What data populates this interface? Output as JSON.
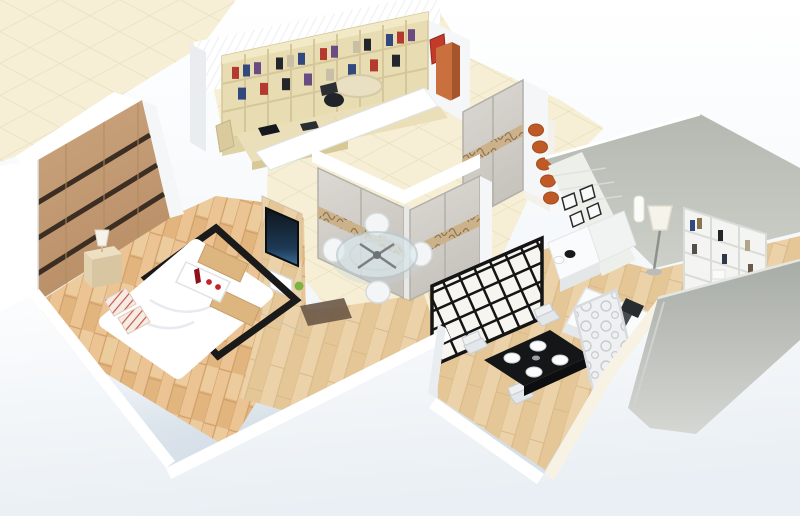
{
  "meta": {
    "title": "3D isometric apartment floor plan render",
    "type": "architectural-3d-render",
    "description": "Isometric cutaway render of a small apartment: bedroom with wardrobe and double bed, study with bookshelf wall, walk-in closet with sliding wardrobes and glass table set, home office with white shelving and floor lamp, dining nook with black table and lattice screen, all set on cream diamond tiles with white cut walls."
  },
  "palette": {
    "bgTop": "#ffffff",
    "bgBottom": "#d9e3ec",
    "tile": "#f6efd5",
    "tileLine": "#e6dcba",
    "tileStudy": "#f3ecd2",
    "wallWhite": "#ffffff",
    "wallSoft": "#f4f6f7",
    "wallShade": "#e9edef",
    "wallEdge": "#dde3e6",
    "ridge": "#eef1f3",
    "grayA": "#b4b8b0",
    "grayB": "#ccd0c8",
    "grayC": "#a8aca6",
    "grayD": "#d4d7d2",
    "woodA": "#ecc393",
    "woodB": "#e3b57e",
    "woodSeam": "#cf9f69",
    "woodPale": "#f4dcb4",
    "woodA2": "#ecd2a9",
    "woodB2": "#e5c797",
    "woodSeam2": "#d9b988",
    "wardWoodA": "#cba67f",
    "wardWoodB": "#b98e67",
    "wardStripe": "#3c2e22",
    "shelfWood": "#e8ddb2",
    "shelfEdge": "#d5c79a",
    "shelfBase": "#dfd3a6",
    "deskWood": "#eadfb8",
    "deskEdge": "#d6c996",
    "bookRed": "#b23a2e",
    "bookBlue": "#31497c",
    "bookPurple": "#6a4b82",
    "bookDark": "#23262b",
    "bookTan": "#c8bfa4",
    "accentOrange": "#c9703e",
    "accentOrangeDark": "#a4552a",
    "discOrange": "#bf5a26",
    "artRed": "#c23a2a",
    "doorA": "#dcd9d4",
    "doorB": "#c6c2bc",
    "doorFrame": "#b3afa9",
    "bandBg": "#cbb28b",
    "bandLine": "#8e7352",
    "tvDark": "#0e151d",
    "tvGlow": "#3e6f9e",
    "rugBlack": "#1a1a1a",
    "black": "#141618",
    "chairDark": "#202428",
    "glassFill": "#dce8ec",
    "glassRim": "#b9c6cb",
    "white": "#ffffff",
    "duvetShade": "#e7eaee",
    "itemRed": "#c3242c",
    "bottleRed": "#8e1018",
    "plantGreen": "#7cb342",
    "lampShade": "#f6f3ea",
    "screenFill": "#eef0f1",
    "curl": "#c8ccd0",
    "latticeBg": "#f7f5ef",
    "latticeLine": "#151515",
    "slatWall": "#edf0ea",
    "slatLine": "#dde0da",
    "tableWhite": "#fafbfc",
    "blotter": "#474c52",
    "runner": "#6b5847",
    "cream": "#f7f2e4"
  },
  "scene": {
    "label": "3D isometric apartment model",
    "rooms": {
      "bedroom": {
        "label": "Bedroom with wood floor, striped wardrobe and double bed"
      },
      "study": {
        "label": "Study with wall bookshelf and corner desk"
      },
      "closet": {
        "label": "Walk-in closet with sliding-door wardrobes and glass table set"
      },
      "office": {
        "label": "Home office with white shelving, desk and floor lamp"
      },
      "dining": {
        "label": "Dining nook with black table and lattice screen"
      },
      "ground": {
        "label": "Cream diamond-tiled ground plane"
      }
    },
    "furniture": {
      "bed": {
        "label": "Double bed with white duvet"
      },
      "bedRug": {
        "label": "Black border rug under bed"
      },
      "wardrobe": {
        "label": "Bedroom wardrobe with dark stripes"
      },
      "nightstand": {
        "label": "Nightstand with table lamp"
      },
      "tray": {
        "label": "Breakfast tray with red bottle and cups"
      },
      "pillows": {
        "label": "Striped pillows"
      },
      "tvPartition": {
        "label": "TV partition wall with flat screen"
      },
      "bookshelfWall": {
        "label": "Study bookshelf wall full of books"
      },
      "studyDesk": {
        "label": "Study corner desk with laptop and chair"
      },
      "orangeCabinet": {
        "label": "Orange tall cabinet"
      },
      "wallArt": {
        "label": "Red wall art"
      },
      "slidingWardrobes": {
        "label": "L-shaped sliding-door wardrobes with decorative band"
      },
      "neWardrobe": {
        "label": "Sliding-door wardrobe with decorative band"
      },
      "accentDiscs": {
        "label": "Orange半round wall accents"
      },
      "glassTable": {
        "label": "Round glass table with four white chairs"
      },
      "latticeScreen": {
        "label": "Black lattice partition screen"
      },
      "carvedScreen": {
        "label": "White carved divider screen"
      },
      "diningTable": {
        "label": "Black dining table with white plates and chairs"
      },
      "sideboard": {
        "label": "Stepped white sideboard with black bowl"
      },
      "frames": {
        "label": "Black picture frames"
      },
      "floorLamp": {
        "label": "Floor lamp with white shade"
      },
      "whiteBookshelf": {
        "label": "White office bookshelf"
      },
      "officeDesk": {
        "label": "White office desk with black chair"
      },
      "runnerRug": {
        "label": "Dark patterned runner rug"
      }
    }
  }
}
